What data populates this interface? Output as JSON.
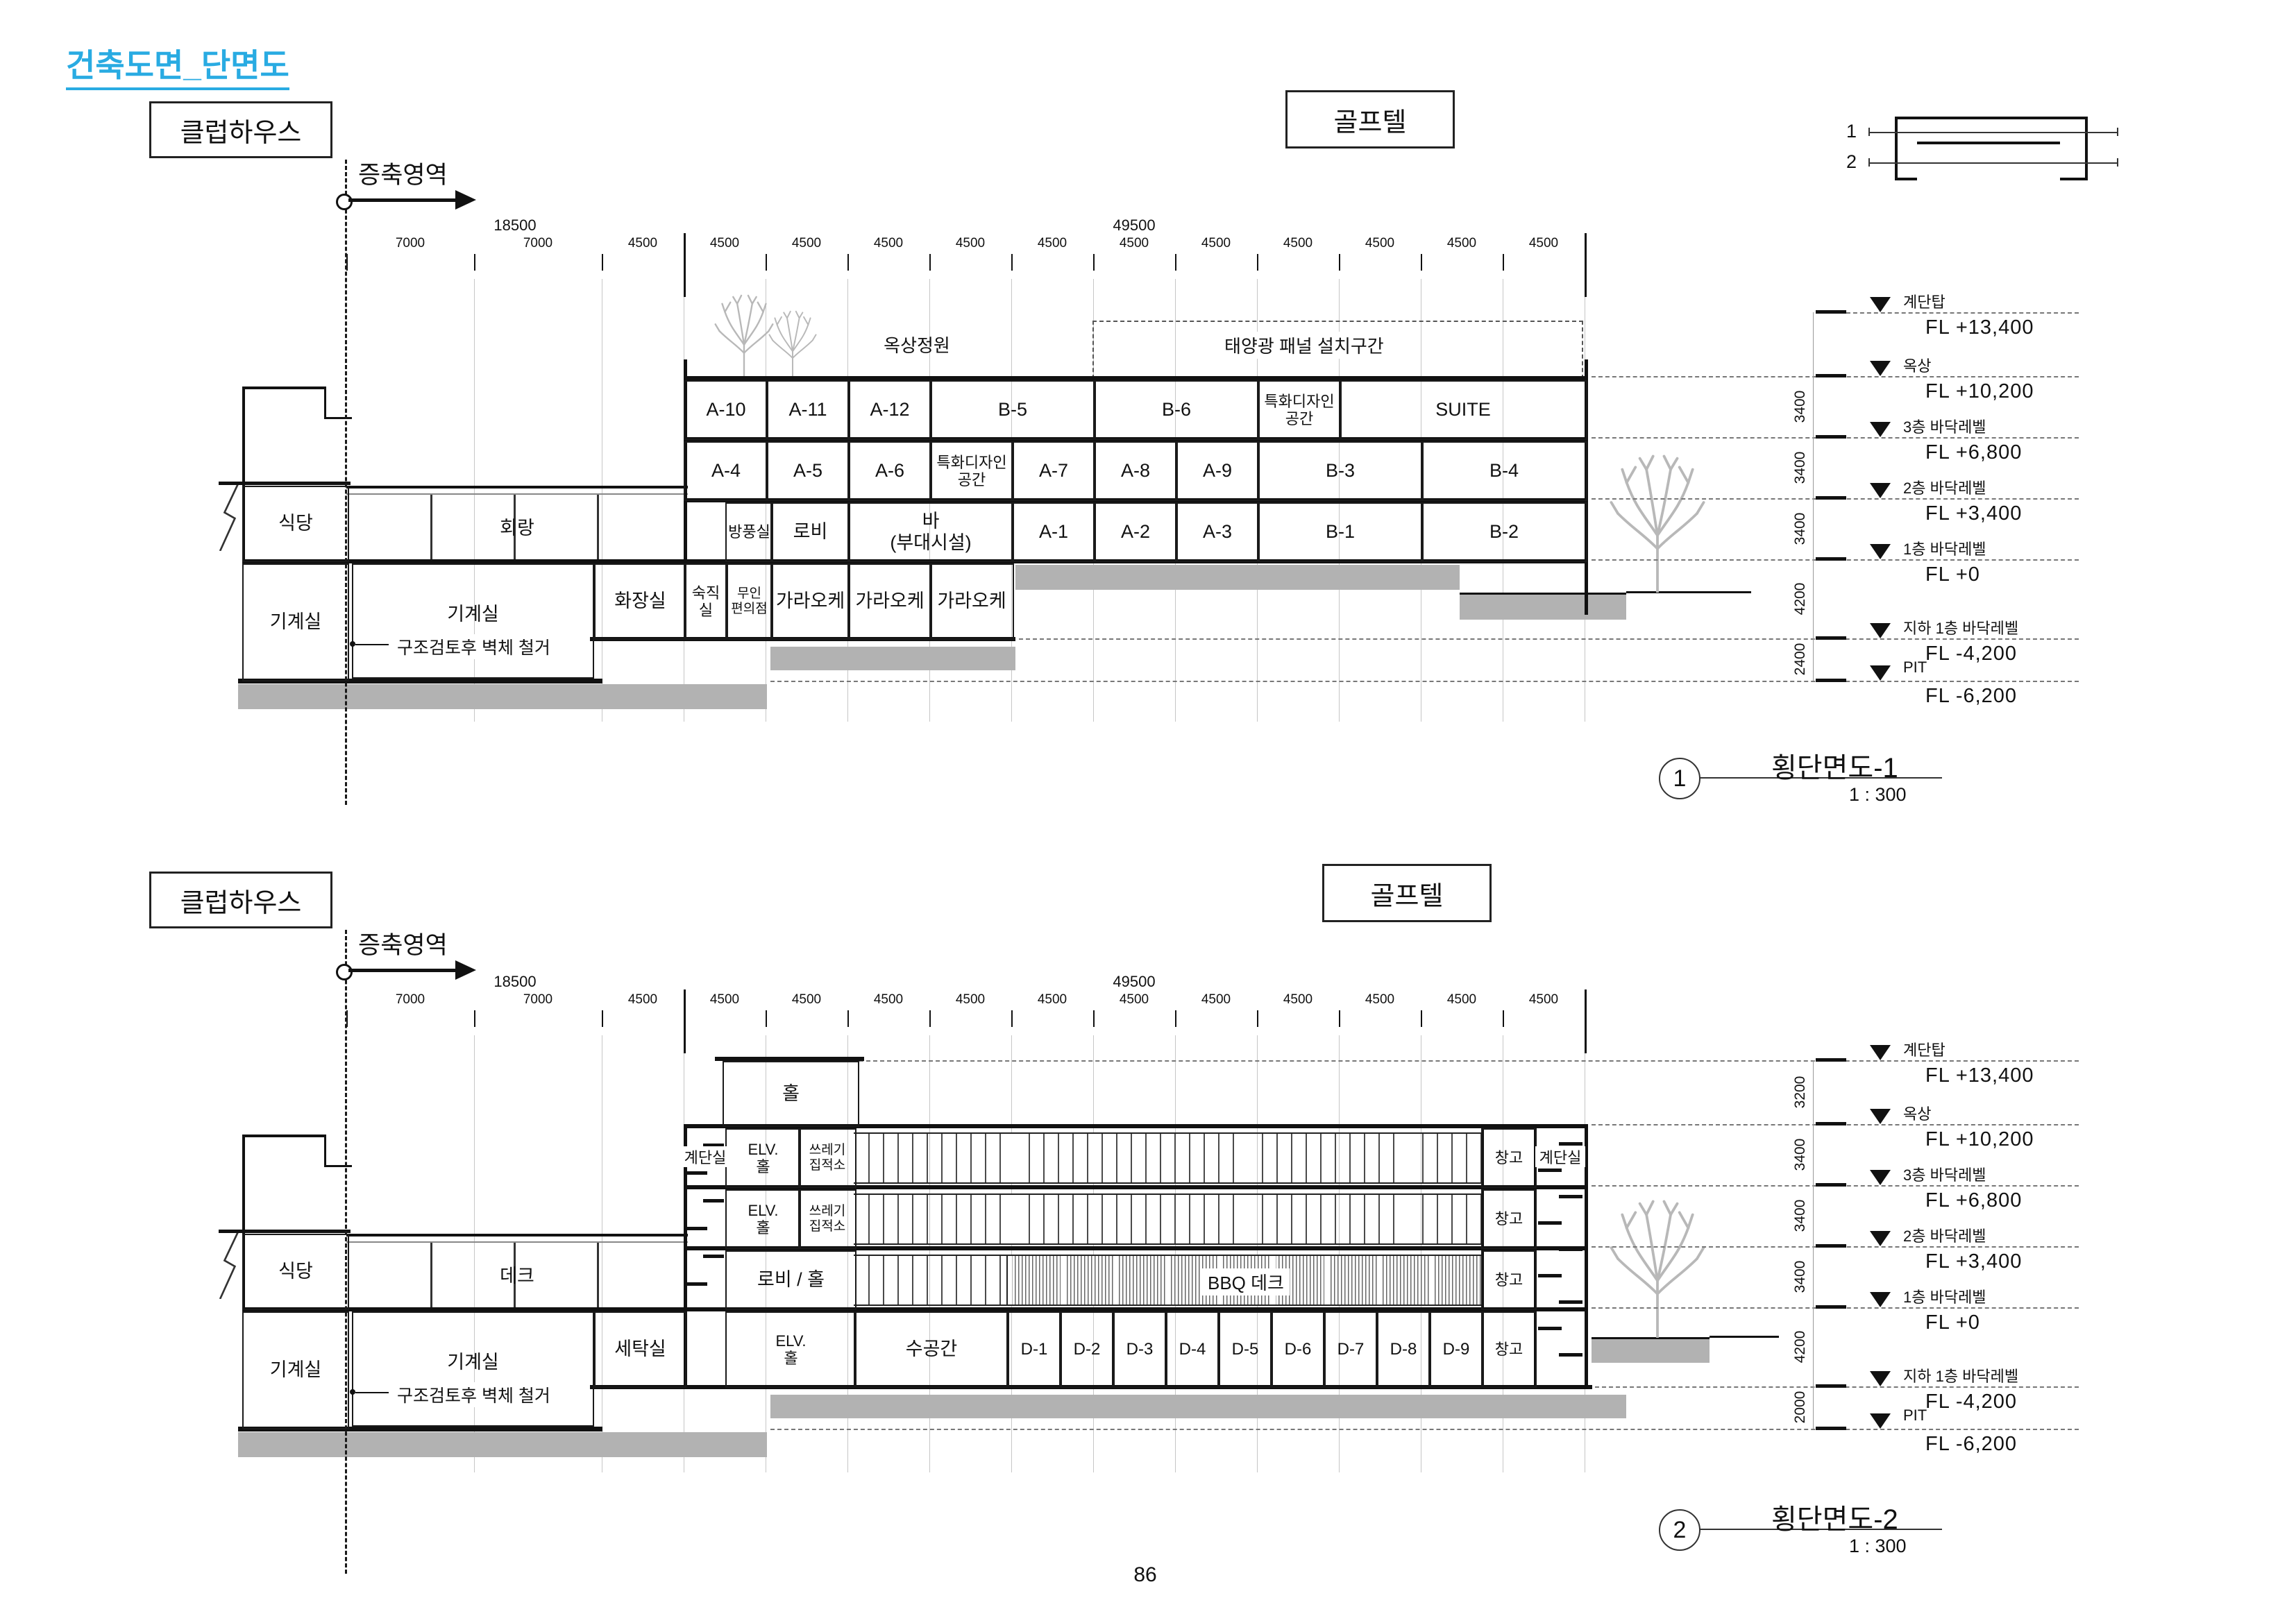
{
  "page": {
    "doc_title": "건축도면_단면도",
    "page_number": "86",
    "accent_color": "#29abe2"
  },
  "key_plan": {
    "line1": "1",
    "line2": "2"
  },
  "s1": {
    "clubhouse": "클럽하우스",
    "golftel": "골프텔",
    "extension": "증축영역",
    "title": "횡단면도-1",
    "scale": "1 : 300",
    "bubble": "1",
    "roof_garden": "옥상정원",
    "solar": "태양광 패널 설치구간",
    "demolition": "구조검토후 벽체 철거",
    "dims": {
      "g_left": "18500",
      "g_right": "49500",
      "bays": [
        "7000",
        "7000",
        "4500",
        "4500",
        "4500",
        "4500",
        "4500",
        "4500",
        "4500",
        "4500",
        "4500",
        "4500",
        "4500",
        "4500"
      ]
    },
    "f3": [
      "A-10",
      "A-11",
      "A-12",
      "B-5",
      "B-6",
      "특화디자인\n공간",
      "SUITE"
    ],
    "f2": [
      "A-4",
      "A-5",
      "A-6",
      "특화디자인\n공간",
      "A-7",
      "A-8",
      "A-9",
      "B-3",
      "B-4"
    ],
    "f1": [
      "방풍실",
      "로비",
      "바\n(부대시설)",
      "A-1",
      "A-2",
      "A-3",
      "B-1",
      "B-2"
    ],
    "b1": [
      "화장실",
      "숙직실",
      "무인\n편의점",
      "가라오케",
      "가라오케",
      "가라오케"
    ],
    "club_rooms": [
      "식당",
      "회랑",
      "기계실",
      "기계실"
    ],
    "levels": [
      {
        "n": "계단탑",
        "fl": "FL +13,400"
      },
      {
        "n": "옥상",
        "fl": "FL +10,200"
      },
      {
        "n": "3층 바닥레벨",
        "fl": "FL +6,800"
      },
      {
        "n": "2층 바닥레벨",
        "fl": "FL +3,400"
      },
      {
        "n": "1층 바닥레벨",
        "fl": "FL +0"
      },
      {
        "n": "지하 1층 바닥레벨",
        "fl": "FL -4,200"
      },
      {
        "n": "PIT",
        "fl": "FL -6,200"
      }
    ],
    "vdims": [
      "3400",
      "3400",
      "3400",
      "4200",
      "2400"
    ]
  },
  "s2": {
    "clubhouse": "클럽하우스",
    "golftel": "골프텔",
    "extension": "증축영역",
    "title": "횡단면도-2",
    "scale": "1 : 300",
    "bubble": "2",
    "demolition": "구조검토후 벽체 철거",
    "dims": {
      "g_left": "18500",
      "g_right": "49500",
      "bays": [
        "7000",
        "7000",
        "4500",
        "4500",
        "4500",
        "4500",
        "4500",
        "4500",
        "4500",
        "4500",
        "4500",
        "4500",
        "4500",
        "4500"
      ]
    },
    "tower": {
      "hall": "홀",
      "stair": "계단실",
      "elv": "ELV.\n홀",
      "trash": "쓰레기\n집적소",
      "lobby": "로비 / 홀"
    },
    "bbq": "BBQ 데크",
    "water": "수공간",
    "d": [
      "D-1",
      "D-2",
      "D-3",
      "D-4",
      "D-5",
      "D-6",
      "D-7",
      "D-8",
      "D-9"
    ],
    "right": {
      "storage": "창고",
      "stair": "계단실"
    },
    "club_rooms": [
      "식당",
      "데크",
      "기계실",
      "기계실",
      "세탁실"
    ],
    "levels": [
      {
        "n": "계단탑",
        "fl": "FL +13,400"
      },
      {
        "n": "옥상",
        "fl": "FL +10,200"
      },
      {
        "n": "3층 바닥레벨",
        "fl": "FL +6,800"
      },
      {
        "n": "2층 바닥레벨",
        "fl": "FL +3,400"
      },
      {
        "n": "1층 바닥레벨",
        "fl": "FL +0"
      },
      {
        "n": "지하 1층 바닥레벨",
        "fl": "FL -4,200"
      },
      {
        "n": "PIT",
        "fl": "FL -6,200"
      }
    ],
    "vdims": [
      "3200",
      "3400",
      "3400",
      "3400",
      "4200",
      "2000"
    ]
  }
}
